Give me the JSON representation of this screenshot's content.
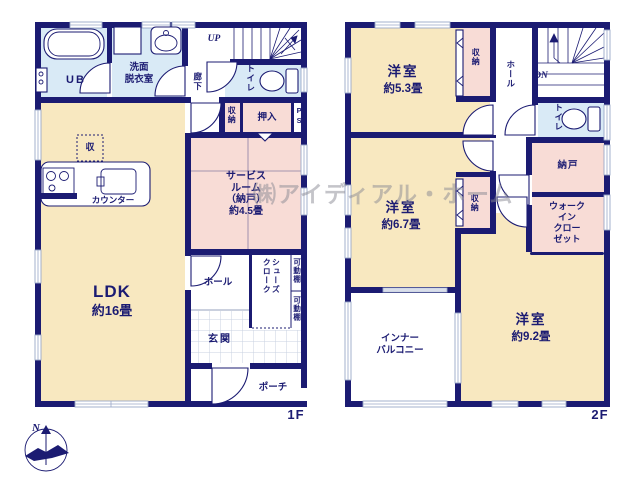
{
  "watermark": {
    "text": "㈱アイディアル・ホーム"
  },
  "compass": {
    "north": "N"
  },
  "colors": {
    "wall": "#1b1b72",
    "room_cream": "#f8e8c0",
    "room_pink": "#f8dcd6",
    "room_blue": "#d9eaf6",
    "tile_line": "#c9d2e0",
    "watermark": "#8a8a94"
  },
  "f1": {
    "label": "1F",
    "ub": "UB",
    "washroom": [
      "洗面",
      "脱衣室"
    ],
    "up": "UP",
    "hallway": "廊下",
    "toilet": "トイレ",
    "closet": "収納",
    "oshiire": "押入",
    "ps": "PS",
    "service": [
      "サービス",
      "ルーム",
      "（納戸）",
      "約4.5畳"
    ],
    "storage_box": "収",
    "counter": "カウンター",
    "ldk_name": "LDK",
    "ldk_size": "約16畳",
    "hall": "ホール",
    "shoes_cloak": [
      "シューズ",
      "クローク"
    ],
    "shelf": "可動棚",
    "genkan": "玄関",
    "porch": "ポーチ"
  },
  "f2": {
    "label": "2F",
    "r53_name": "洋室",
    "r53_size": "約5.3畳",
    "closet": "収納",
    "hall": "ホール",
    "dn": "DN",
    "toilet": "トイレ",
    "nando": "納戸",
    "wic": [
      "ウォーク",
      "イン",
      "クロー",
      "ゼット"
    ],
    "r67_name": "洋室",
    "r67_size": "約6.7畳",
    "r92_name": "洋室",
    "r92_size": "約9.2畳",
    "balcony": [
      "インナー",
      "バルコニー"
    ]
  }
}
